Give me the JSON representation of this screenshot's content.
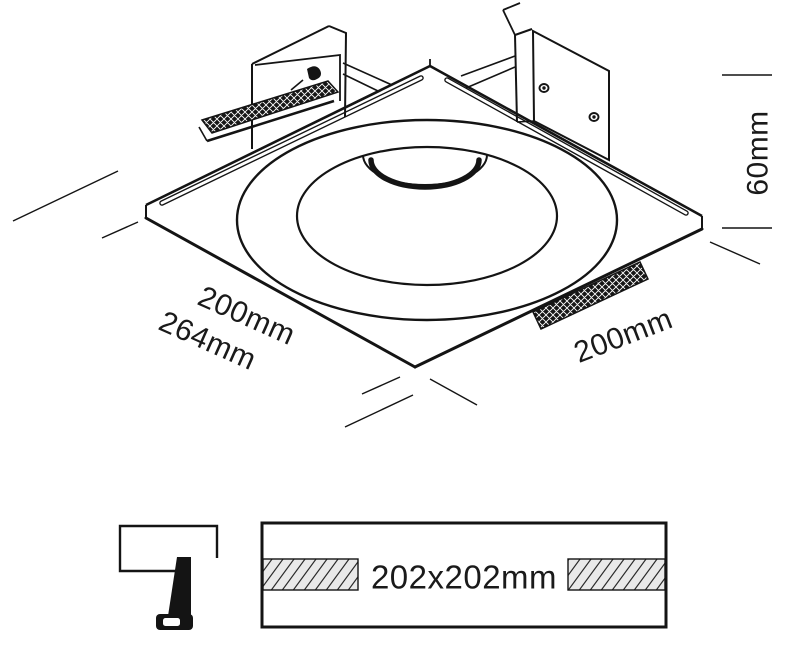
{
  "drawing": {
    "dimensions": {
      "front_edge_width": "200mm",
      "overall_width": "264mm",
      "side_edge_depth": "200mm",
      "recess_height": "60mm"
    },
    "cutout": {
      "size": "202x202mm"
    },
    "colors": {
      "line": "#141414",
      "hatch_fill": "#e9e9e9",
      "background": "#ffffff"
    }
  }
}
